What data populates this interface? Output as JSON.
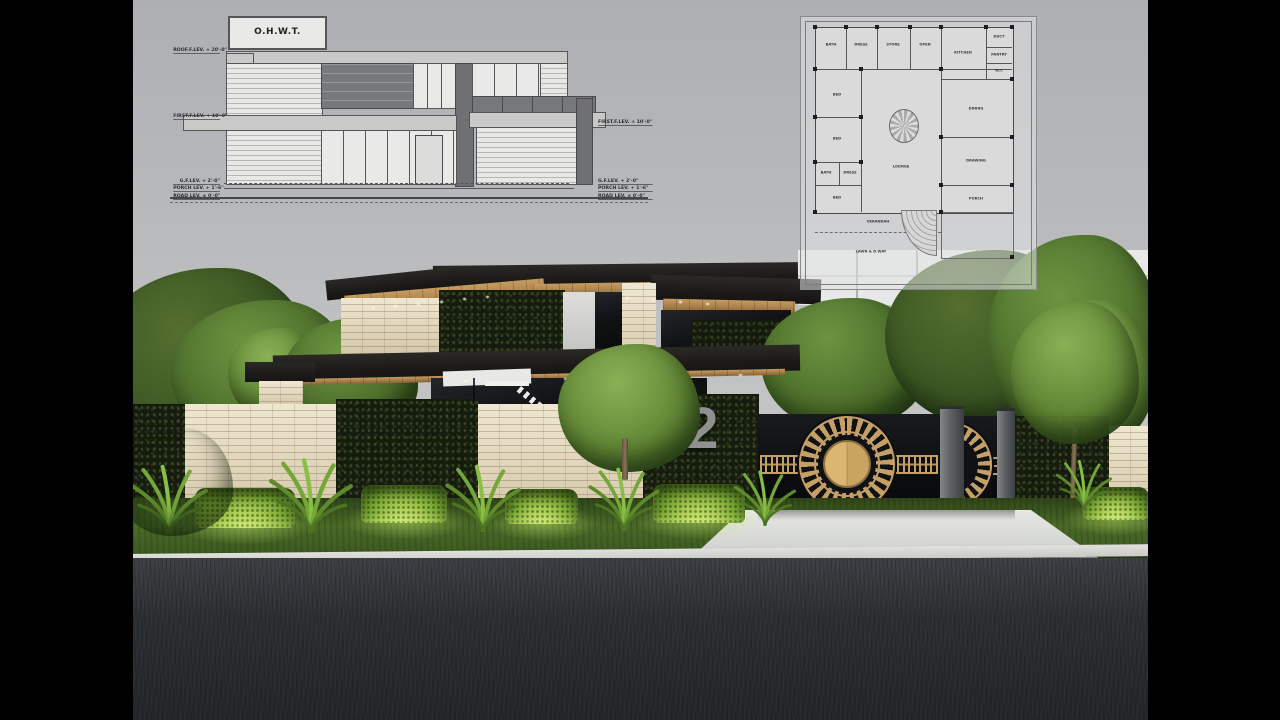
{
  "scene": {
    "house_number": "52"
  },
  "elevation": {
    "title": "O.H.W.T.",
    "labels_left": [
      "ROOF.F.LEV. + 20'-0\"",
      "FIRST.F.LEV. + 10'-0\"",
      "G.F.LEV. + 2'-0\"",
      "PORCH LEV. + 1'-6\"",
      "ROAD LEV. ± 0'-0\""
    ],
    "labels_right": [
      "FIRST.F.LEV. + 10'-0\"",
      "G.F.LEV. + 2'-0\"",
      "PORCH LEV. + 1'-6\"",
      "ROAD LEV. ± 0'-0\""
    ]
  },
  "floor_plan": {
    "rooms": [
      "BATH",
      "DRESS",
      "STORE",
      "OPEN",
      "DUCT",
      "KITCHEN",
      "PANTRY",
      "W.C",
      "BED",
      "DINING",
      "BED",
      "LOUNGE",
      "DRAWING",
      "BATH",
      "DRESS",
      "BED",
      "VERANDAH",
      "PORCH",
      "LAWN & D.WAY"
    ]
  },
  "colors": {
    "accent_gold": "#c5a066",
    "gate_black": "#101114",
    "stone_beige": "#e4dac2",
    "hedge_dark": "#1a2112",
    "sky_gray": "#bcbec0",
    "road_asphalt": "#2b2e31",
    "driveway": "#dcdedb",
    "grass": "#44622a",
    "lit_hedge": "#a6cf55",
    "house_number_gray": "#8e918e",
    "timber": "#b08d54"
  }
}
